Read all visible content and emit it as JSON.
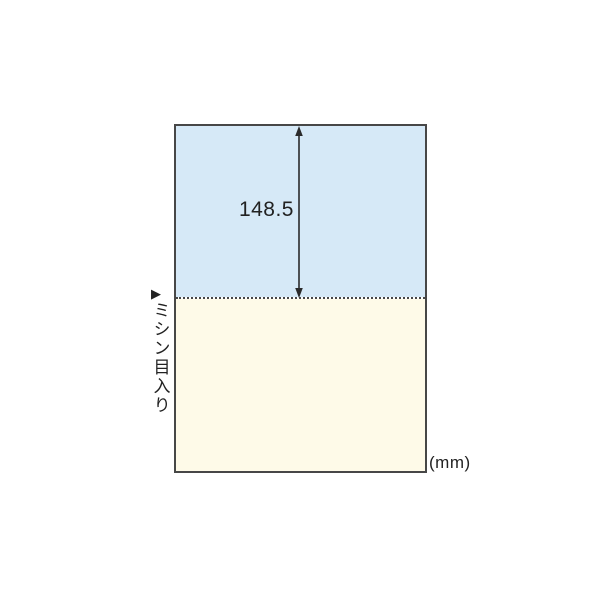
{
  "diagram": {
    "dimension_label": "148.5",
    "unit_label": "(mm)",
    "perforation_marker": "▶",
    "perforation_label": "ミシン目入り",
    "colors": {
      "top_half": "#d6e9f7",
      "bottom_half": "#fefae8",
      "border": "#474747",
      "text": "#222222",
      "arrow": "#2b2b2b"
    }
  }
}
